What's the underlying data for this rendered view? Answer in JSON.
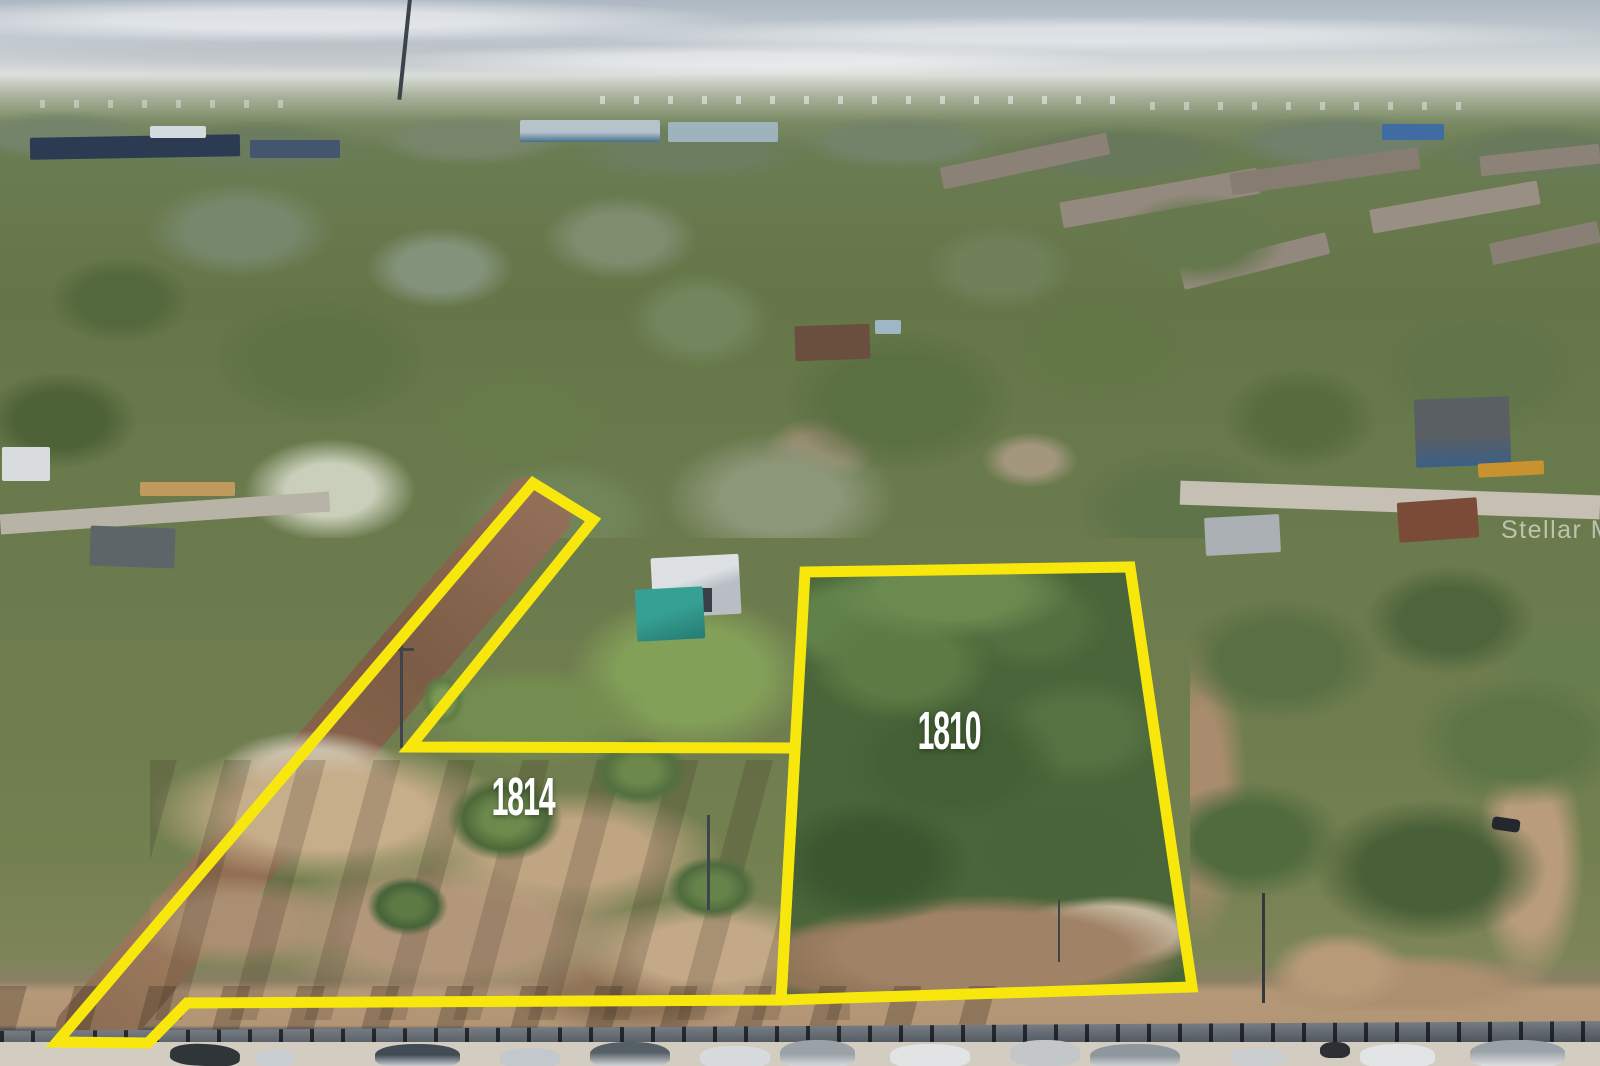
{
  "watermark": {
    "text": "Stellar MLS"
  },
  "annotations": {
    "outline_color": "#F8E70D",
    "label_color": "#FFFFFF",
    "parcels": [
      {
        "id": "1814",
        "label": "1814",
        "label_x": 523,
        "label_y": 797,
        "points": "533,483 593,520 410,747 795,748 781,1000 187,1003 148,1043 57,1042"
      },
      {
        "id": "1810",
        "label": "1810",
        "label_x": 949,
        "label_y": 731,
        "points": "805,572 1130,567 1192,987 781,1000"
      }
    ]
  }
}
